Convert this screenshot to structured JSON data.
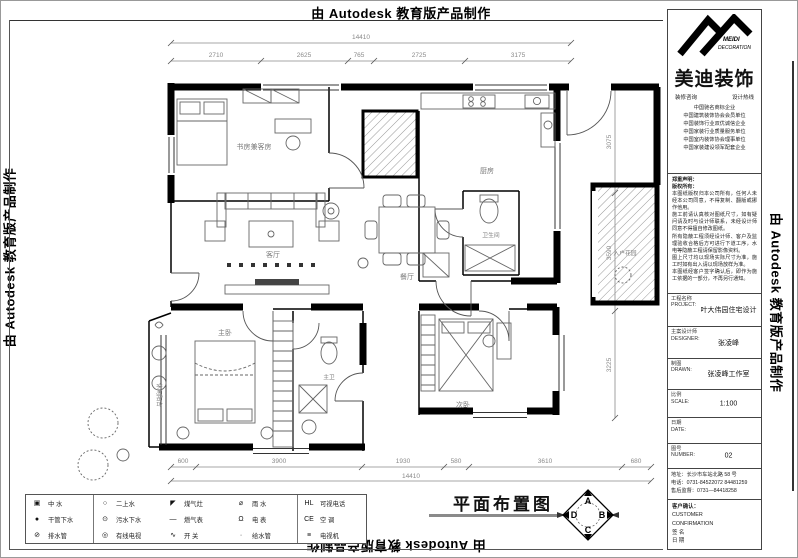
{
  "banner_text": "由 Autodesk 教育版产品制作",
  "logo": {
    "name_en1": "MEIDI",
    "name_en2": "DECORATION",
    "name_cn": "美迪装饰",
    "tagline_left": "装修咨询",
    "tagline_right": "设计热线",
    "credentials": [
      "中国驰名商标企业",
      "中国建筑装饰协会会员单位",
      "中国装饰行业双优诚信企业",
      "中国家装行业质量服务单位",
      "中国室内装饰协会理事单位",
      "中国家装建设领军配套企业"
    ]
  },
  "notes": {
    "lines": [
      "郑重声明：",
      "版权所有：",
      "本图纸版权归本公司所有，任何人未经本公司同意，不得复制、翻版或挪作他用。",
      "施工前请认真核对图纸尺寸，如有疑问请及时与设计师联系，未经设计师同意不得擅自修改图纸。",
      "所有隐蔽工程须经设计师、客户及监理验收合格后方可进行下道工序，水电等隐蔽工程请保留影像资料。",
      "图上尺寸均以现场实际尺寸为准，施工时如有出入请以现场放样为准。",
      "本图纸经客户签字确认后，即作为施工依据的一部分，不再另行通知。"
    ]
  },
  "title_block": {
    "fields": [
      {
        "label": "工程名称",
        "en": "PROJECT:",
        "value": "叶大伟园住宅设计"
      },
      {
        "label": "主案设计师",
        "en": "DESIGNER:",
        "value": "张凌峰"
      },
      {
        "label": "制图",
        "en": "DRAWN:",
        "value": "张凌峰工作室"
      },
      {
        "label": "比例",
        "en": "SCALE:",
        "value": "1:100"
      },
      {
        "label": "日期",
        "en": "DATE:",
        "value": ""
      },
      {
        "label": "图号",
        "en": "NUMBER:",
        "value": "02"
      }
    ],
    "address_lines": [
      "地址：长沙市车站北路 58 号",
      "电话：0731-84522072  84481259",
      "售后监督：0731—84418258"
    ],
    "customer": {
      "title": "客户确认：",
      "en1": "CUSTOMER",
      "en2": "CONFIRMATION",
      "sign": "签 名",
      "date": "日 期"
    }
  },
  "plan": {
    "rooms": {
      "study": "书房兼客房",
      "living": "客厅",
      "dining": "餐厅",
      "kitchen": "厨房",
      "bath": "卫生间",
      "master": "主卧",
      "master_bath": "主卫",
      "bedroom2": "次卧",
      "balcony": "休闲阳台",
      "entry_garden": "入户花园"
    },
    "dims": {
      "top_overall": "14410",
      "top_segments": [
        "2710",
        "2625",
        "765",
        "2725",
        "3175"
      ],
      "bottom_overall": "14410",
      "bottom_segments": [
        "600",
        "3900",
        "1930",
        "580",
        "3610",
        "680"
      ],
      "right_segments": [
        "3075",
        "3590",
        "3225"
      ]
    }
  },
  "legend": {
    "rows": [
      [
        {
          "s": "▣",
          "l": "中 水"
        },
        {
          "s": "○",
          "l": "二上水"
        },
        {
          "s": "◤",
          "l": "煤气灶"
        },
        {
          "s": "⌀",
          "l": "雨 水"
        },
        {
          "s": "HL",
          "l": "可视电话"
        }
      ],
      [
        {
          "s": "●",
          "l": "干管下水"
        },
        {
          "s": "⊙",
          "l": "污水下水"
        },
        {
          "s": "—",
          "l": "燃气表"
        },
        {
          "s": "Ω",
          "l": "电 表"
        },
        {
          "s": "CE",
          "l": "空 调"
        }
      ],
      [
        {
          "s": "⊘",
          "l": "排水管"
        },
        {
          "s": "◎",
          "l": "有线电视"
        },
        {
          "s": "∿",
          "l": "开 关"
        },
        {
          "s": "·",
          "l": "给水管"
        },
        {
          "s": "≡",
          "l": "电视机"
        }
      ]
    ]
  },
  "footer": {
    "drawing_title": "平面布置图",
    "compass": {
      "n": "A",
      "e": "B",
      "s": "C",
      "w": "D"
    }
  }
}
